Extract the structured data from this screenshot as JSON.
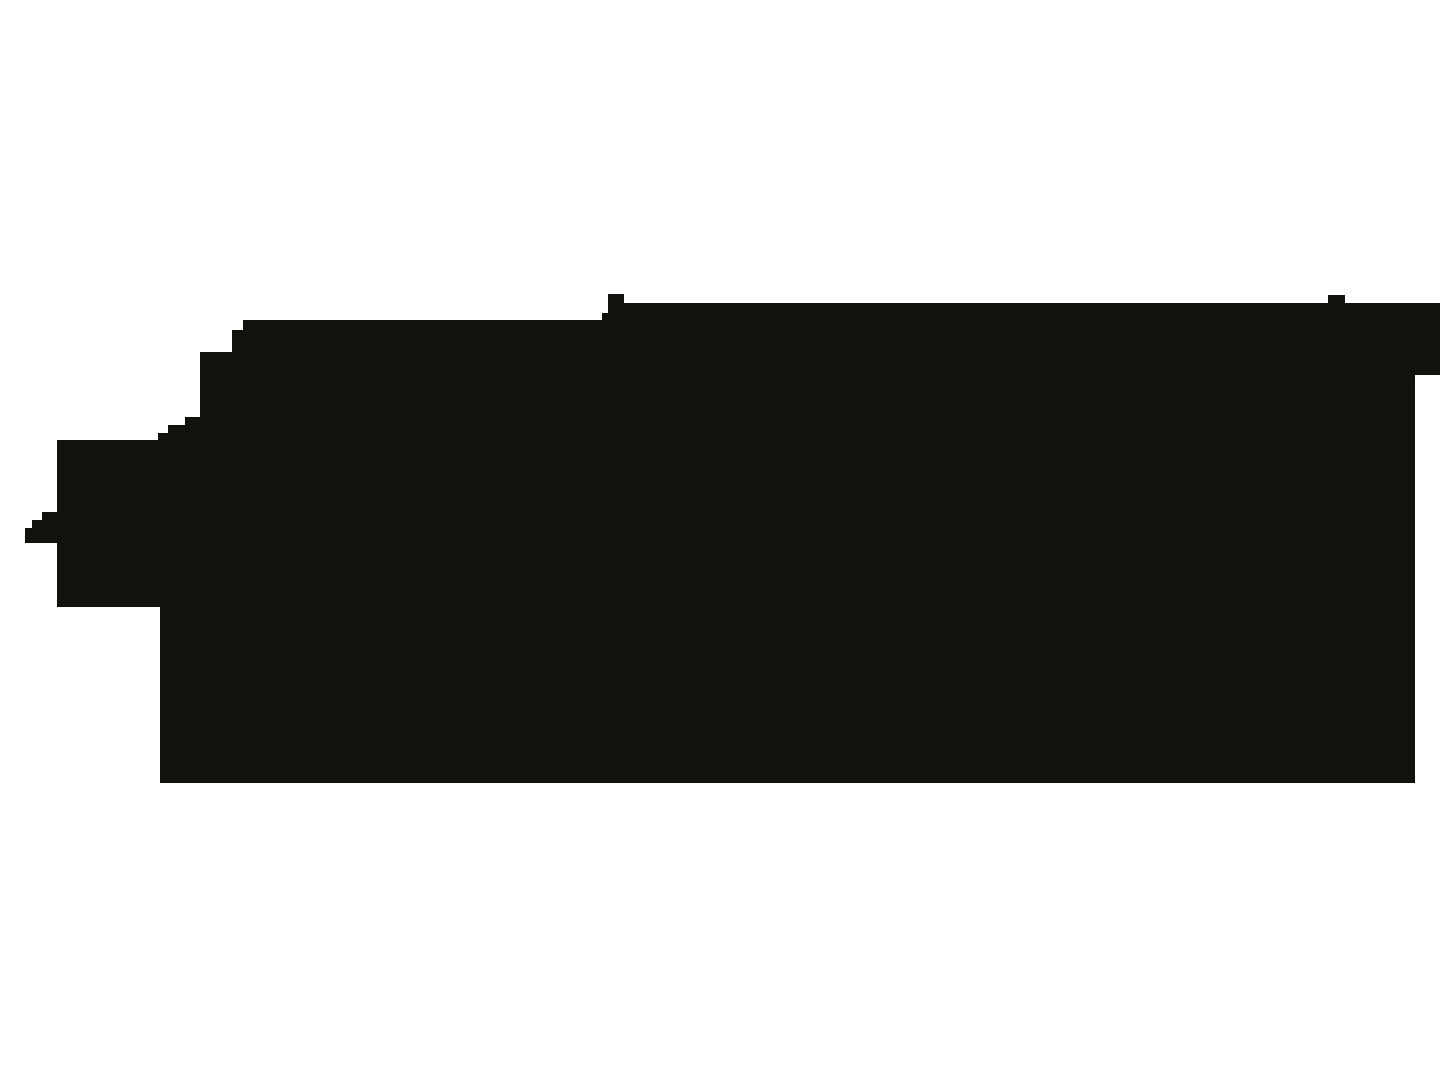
{
  "canvas": {
    "background": "#fffffe",
    "width_px": 1440,
    "height_px": 1080
  },
  "silhouette": {
    "name": "black-stepped-silhouette",
    "fill": "#12110c",
    "points": "243,320 602,320 602,313 608,313 608,294 624,294 624,303 1328,303 1328,295 1345,295 1345,303 1440,303 1440,375 1415,375 1415,783 160,783 160,607 57,607 57,543 25,543 25,528 32,528 32,520 42,520 42,512 57,512 57,440 158,440 158,433 168,433 168,425 185,425 185,417 200,417 200,352 232,352 232,330 243,330"
  }
}
